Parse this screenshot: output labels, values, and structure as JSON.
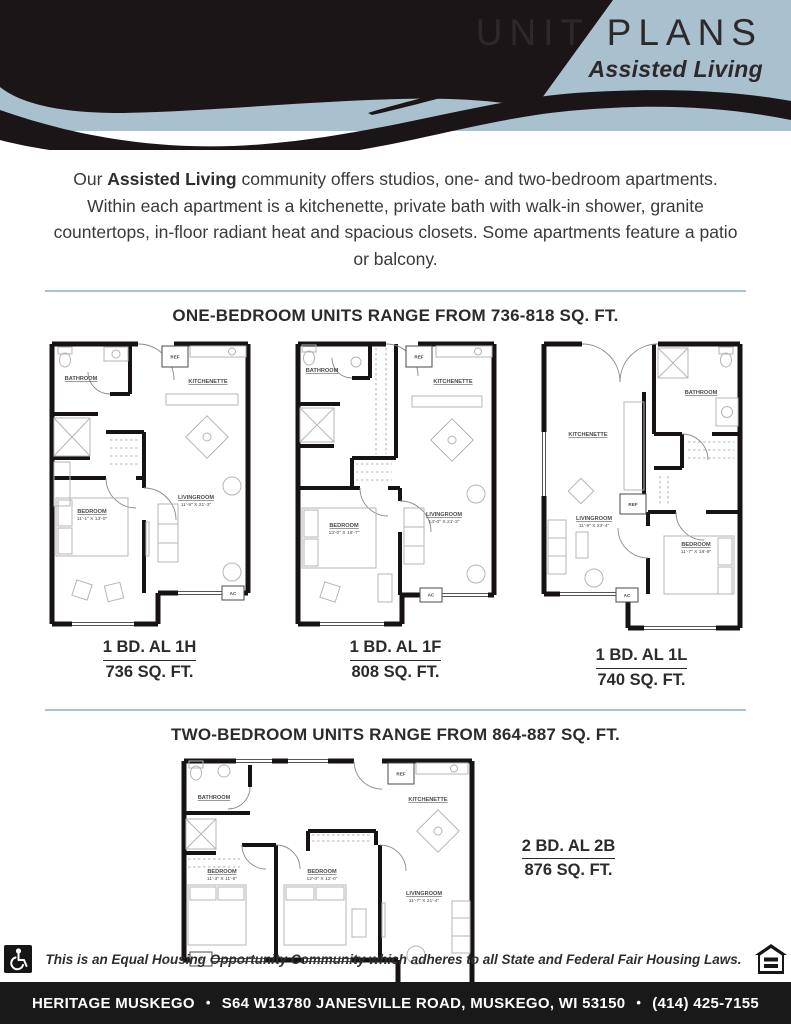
{
  "colors": {
    "band_blue": "#a9c0ce",
    "ink_black": "#1c1517",
    "divider_blue": "#a7c3d2",
    "footer_bg": "#191919"
  },
  "header": {
    "title": "UNIT PLANS",
    "subtitle": "Assisted Living"
  },
  "intro": {
    "lead": "Our ",
    "highlight": "Assisted Living",
    "body": " community offers studios, one- and two-bedroom apartments. Within each apartment is a kitchenette, private bath with walk-in shower, granite countertops, in-floor radiant heat and spacious closets. Some apartments feature a patio or balcony."
  },
  "sections": {
    "one_bedroom": {
      "heading": "ONE-BEDROOM UNITS RANGE FROM 736-818 SQ. FT."
    },
    "two_bedroom": {
      "heading": "TWO-BEDROOM UNITS RANGE FROM 864-887 SQ. FT."
    }
  },
  "plans": {
    "al1h": {
      "caption": "1 BD. AL 1H",
      "area": "736 SQ. FT.",
      "bathroom": "BATHROOM",
      "kitchenette": "KITCHENETTE",
      "ref": "REF",
      "ac": "AC",
      "bedroom": "BEDROOM",
      "bedroom_dims": "11'-1\" X 13'-0\"",
      "livingroom": "LIVINGROOM",
      "livingroom_dims": "11'-9\" X 21'-3\""
    },
    "al1f": {
      "caption": "1 BD. AL 1F",
      "area": "808 SQ. FT.",
      "bathroom": "BATHROOM",
      "kitchenette": "KITCHENETTE",
      "ref": "REF",
      "ac": "AC",
      "bedroom": "BEDROOM",
      "bedroom_dims": "13'-0\" X 16'-7\"",
      "livingroom": "LIVINGROOM",
      "livingroom_dims": "14'-0\" X 21'-3\""
    },
    "al1l": {
      "caption": "1 BD. AL 1L",
      "area": "740 SQ. FT.",
      "bathroom": "BATHROOM",
      "kitchenette": "KITCHENETTE",
      "ref": "REF",
      "ac": "AC",
      "bedroom": "BEDROOM",
      "bedroom_dims": "11'-7\" X 18'-9\"",
      "livingroom": "LIVINGROOM",
      "livingroom_dims": "11'-9\" X 23'-4\""
    },
    "al2b": {
      "caption": "2 BD. AL 2B",
      "area": "876 SQ. FT.",
      "bathroom": "BATHROOM",
      "kitchenette": "KITCHENETTE",
      "ref": "REF",
      "ac": "AC",
      "bedroom1": "BEDROOM",
      "bedroom1_dims": "11'-3\" X 11'-9\"",
      "bedroom2": "BEDROOM",
      "bedroom2_dims": "12'-0\" X 12'-0\"",
      "livingroom": "LIVINGROOM",
      "livingroom_dims": "11'-7\" X 21'-4\""
    }
  },
  "icons": {
    "accessibility": "wheelchair-icon",
    "equal_housing": "equal-housing-icon"
  },
  "disclaimer": "This is an Equal Housing Opportunity Community which adheres to all State and Federal Fair Housing Laws.",
  "footer": {
    "name": "HERITAGE MUSKEGO",
    "bullet": "•",
    "address": "S64 W13780 JANESVILLE ROAD, MUSKEGO, WI 53150",
    "phone": "(414) 425-7155"
  }
}
